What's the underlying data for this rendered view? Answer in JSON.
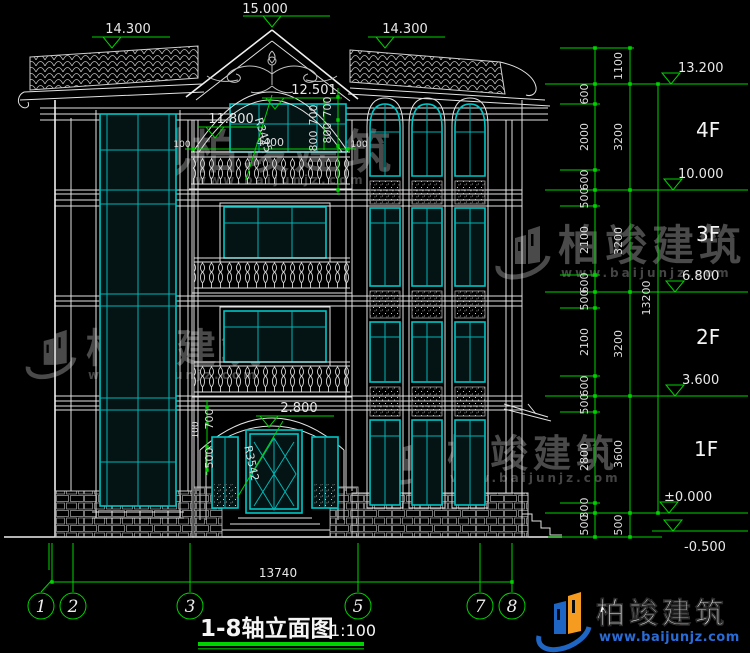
{
  "title_block": {
    "title": "1-8轴立面图",
    "scale": "1:100"
  },
  "axes": {
    "bubbles": [
      "1",
      "2",
      "3",
      "5",
      "7",
      "8"
    ]
  },
  "floors": {
    "labels": [
      "4F",
      "3F",
      "2F",
      "1F"
    ]
  },
  "elevations": {
    "peak": "15.000",
    "left_roof": "14.300",
    "right_roof": "14.300",
    "arch_top": "12.501",
    "balcony_arch": "11.800",
    "entrance": "2.800",
    "right_side": [
      "13.200",
      "10.000",
      "6.800",
      "3.600",
      "±0.000",
      "-0.500"
    ]
  },
  "dimensions": {
    "right_total": "13200",
    "right_top": "1100",
    "right_floor_heights": [
      "3200",
      "3200",
      "3200",
      "3600",
      "500"
    ],
    "right_segments": [
      "600",
      "2000",
      "600",
      "500",
      "2100",
      "600",
      "500",
      "2100",
      "600",
      "500",
      "2800",
      "300",
      "500"
    ],
    "balcony": {
      "width": "4400",
      "end_left": "100",
      "end_right": "100"
    },
    "arch": {
      "rise": "700",
      "lower": "800",
      "radius": "R3425"
    },
    "entrance": {
      "offset": "100",
      "rise": "700",
      "drop": "500",
      "radius": "R3542"
    },
    "overall_width": "13740"
  },
  "watermark": {
    "name": "柏竣建筑",
    "site": "www.baijunjz.com"
  },
  "logo": {
    "name": "柏竣建筑",
    "site": "www.baijunjz.com"
  },
  "colors": {
    "background": "#000000",
    "line": "#e2e2e2",
    "glass": "#00c6c6",
    "dimension": "#00d400",
    "watermark": "#4a4a4a",
    "logo_blue": "#1f66c4",
    "logo_orange": "#f59b1f"
  }
}
